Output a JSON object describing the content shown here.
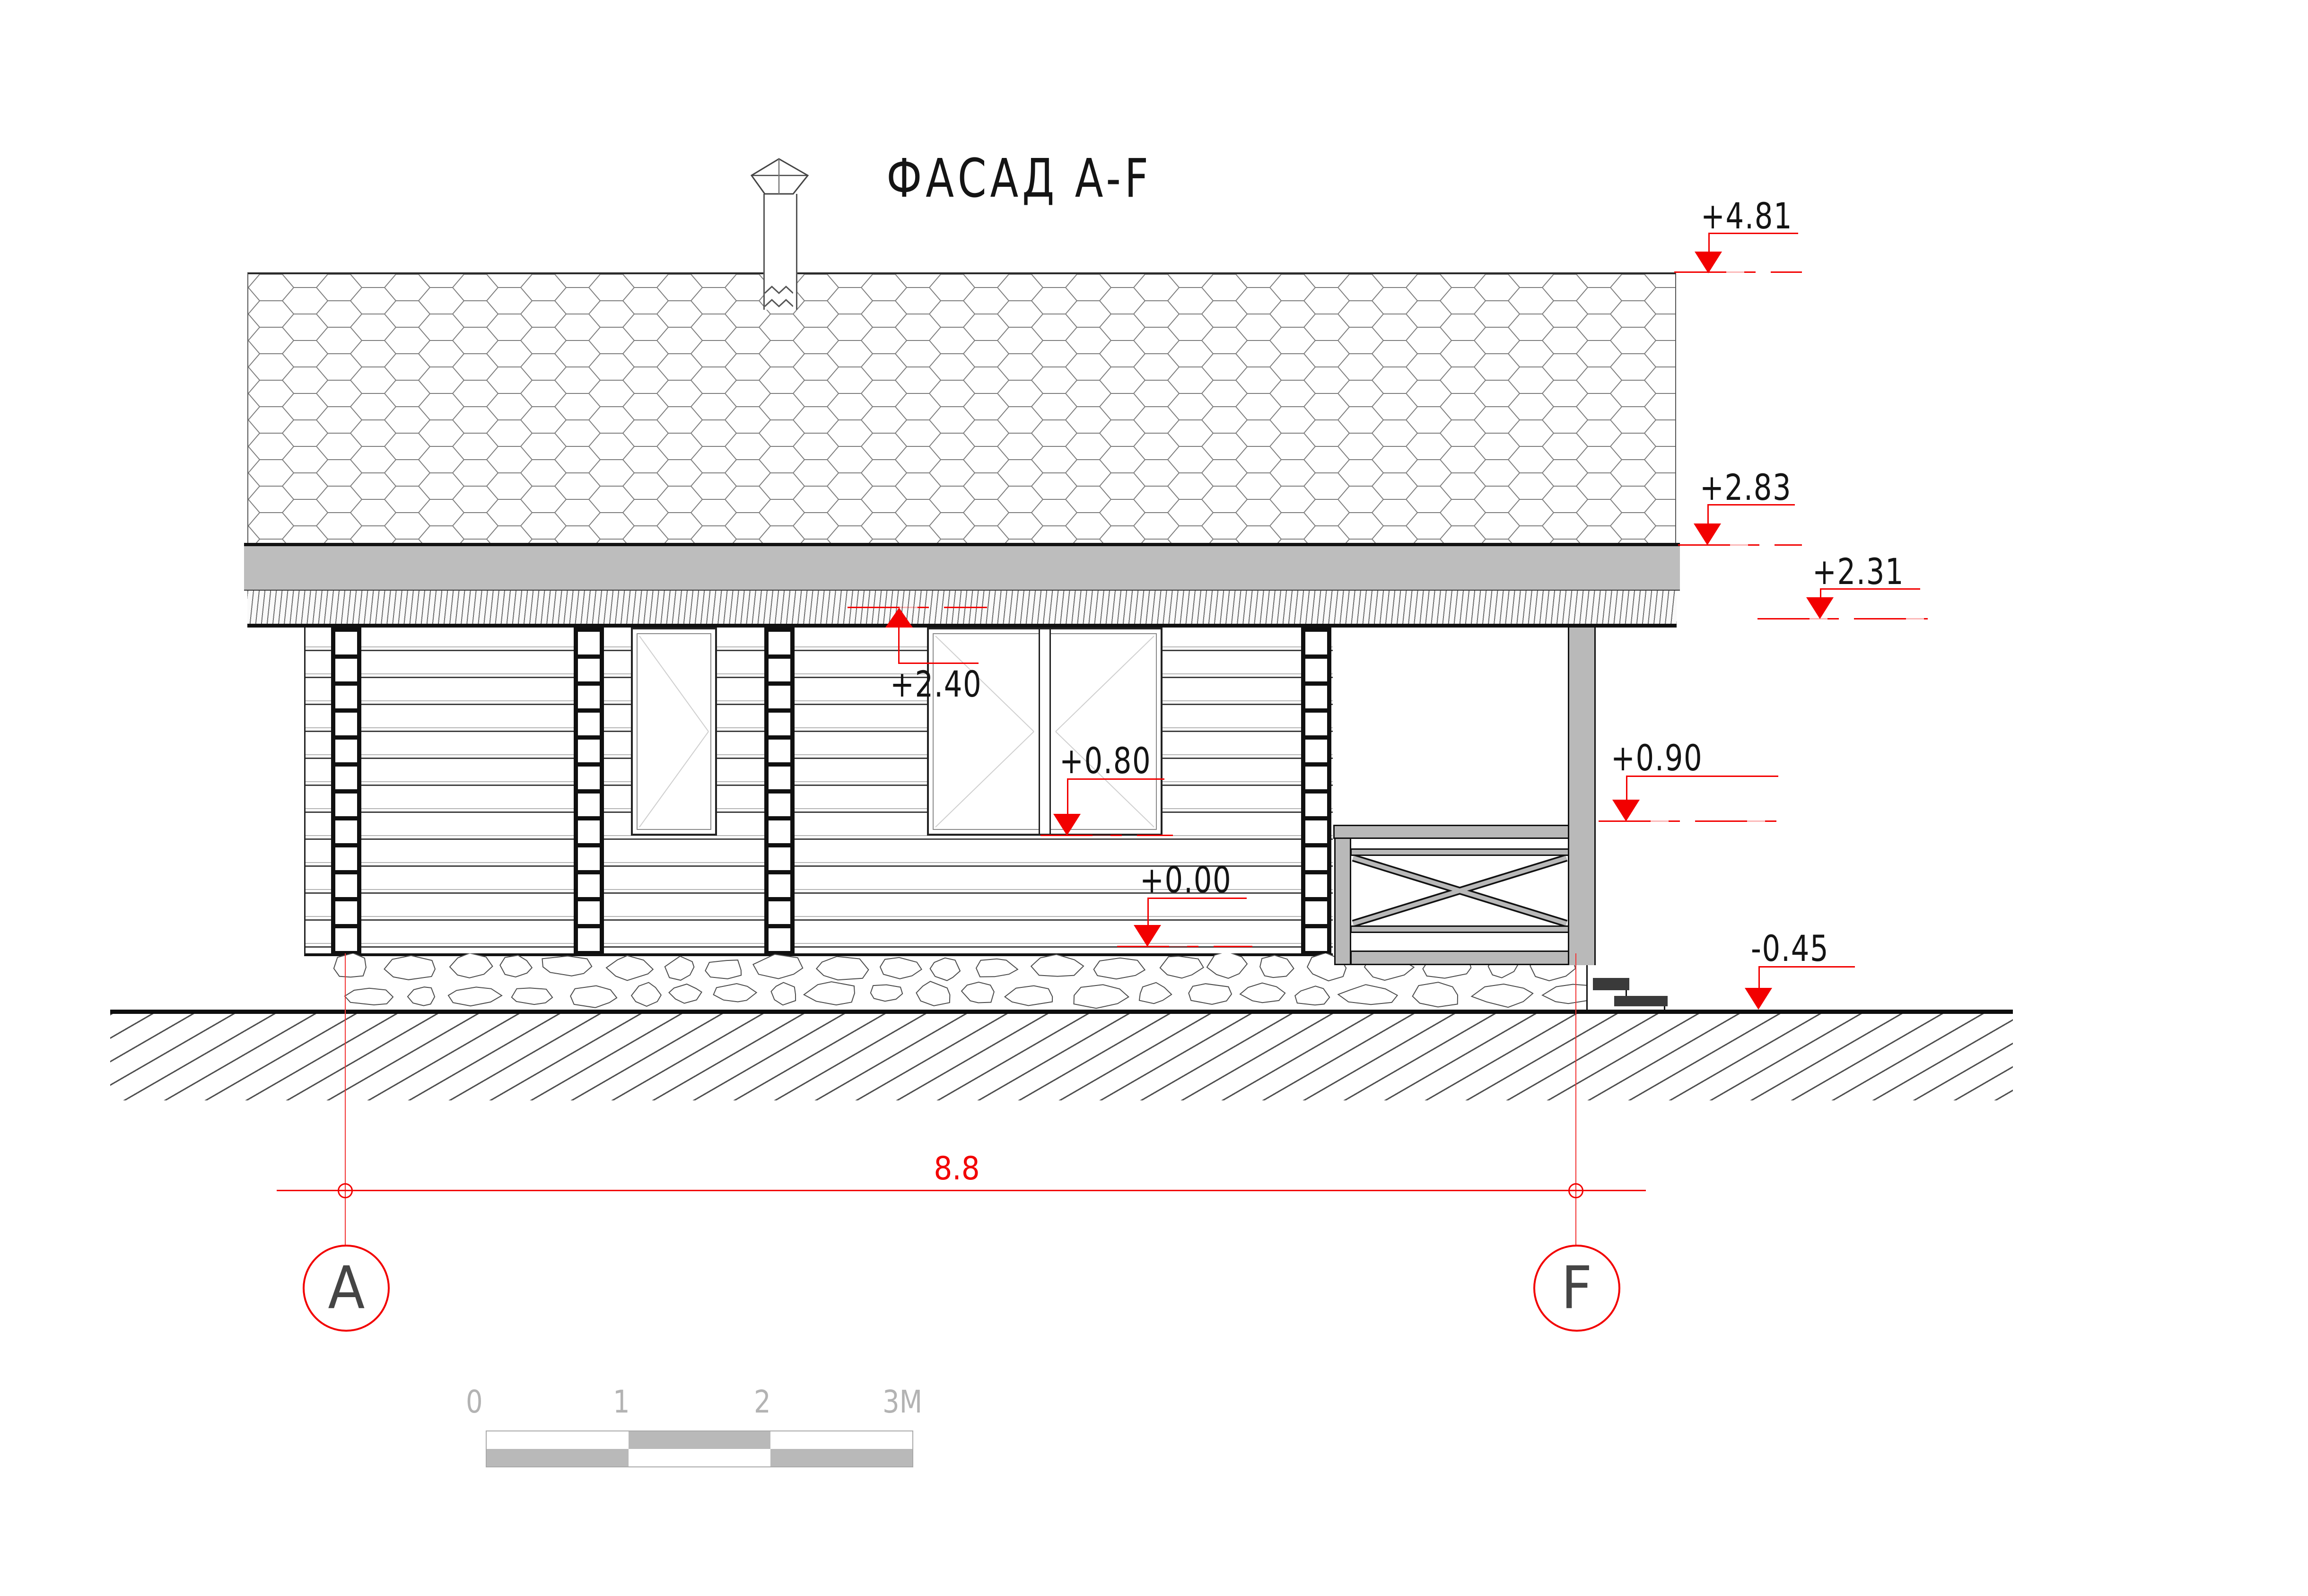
{
  "title": "ФАСАД A-F",
  "elevation_markers": [
    {
      "name": "ridge",
      "label": "+4.81",
      "value_m": 4.81
    },
    {
      "name": "eave-top",
      "label": "+2.83",
      "value_m": 2.83
    },
    {
      "name": "overhang-underside",
      "label": "+2.40",
      "value_m": 2.4
    },
    {
      "name": "porch-roof-edge",
      "label": "+2.31",
      "value_m": 2.31
    },
    {
      "name": "railing-top",
      "label": "+0.90",
      "value_m": 0.9
    },
    {
      "name": "window-sill",
      "label": "+0.80",
      "value_m": 0.8
    },
    {
      "name": "floor-level",
      "label": "+0.00",
      "value_m": 0.0
    },
    {
      "name": "grade-level",
      "label": "-0.45",
      "value_m": -0.45
    }
  ],
  "dimension": {
    "label": "8.8",
    "meters": 8.8
  },
  "axes": {
    "left": "A",
    "right": "F"
  },
  "scale_bar": {
    "labels": [
      "0",
      "1",
      "2",
      "3M"
    ],
    "meters": 3
  },
  "colors": {
    "marker_red": "#f20000",
    "line_black": "#141414",
    "fascia_gray": "#bdbdbd",
    "railing_gray": "#b9b9b9",
    "step_dark": "#3a3a3a",
    "scale_fill_gray": "#b9b9b9",
    "scale_label_gray": "#b3b3b3",
    "axis_letter_gray": "#454545"
  }
}
